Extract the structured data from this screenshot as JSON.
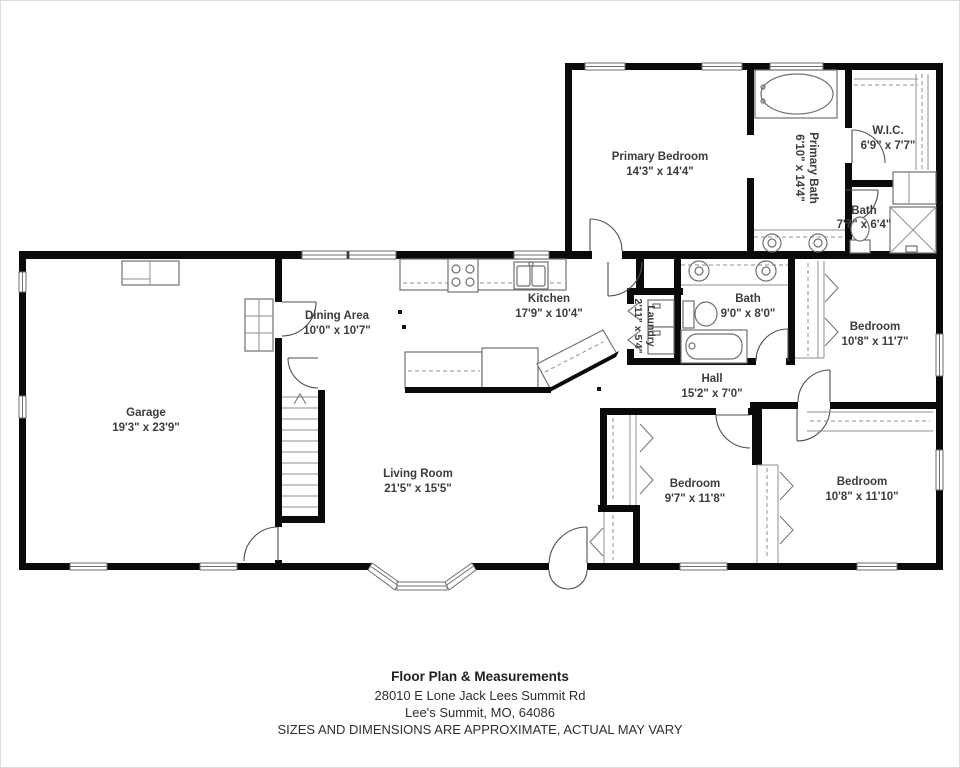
{
  "floorplan": {
    "rooms": {
      "primary_bedroom": {
        "name": "Primary Bedroom",
        "dims": "14'3\" x 14'4\""
      },
      "primary_bath": {
        "name": "Primary Bath",
        "dims": "6'10\" x 14'4\""
      },
      "wic": {
        "name": "W.I.C.",
        "dims": "6'9\" x 7'7\""
      },
      "bath_small": {
        "name": "Bath",
        "dims": "7'7\" x 6'4\""
      },
      "kitchen": {
        "name": "Kitchen",
        "dims": "17'9\" x 10'4\""
      },
      "dining": {
        "name": "Dining Area",
        "dims": "10'0\" x 10'7\""
      },
      "laundry": {
        "name": "Laundry",
        "dims": "2'11\" x 5'4\""
      },
      "bath_main": {
        "name": "Bath",
        "dims": "9'0\" x 8'0\""
      },
      "hall": {
        "name": "Hall",
        "dims": "15'2\" x 7'0\""
      },
      "garage": {
        "name": "Garage",
        "dims": "19'3\" x 23'9\""
      },
      "living": {
        "name": "Living Room",
        "dims": "21'5\" x 15'5\""
      },
      "bedroom_left": {
        "name": "Bedroom",
        "dims": "9'7\" x 11'8\""
      },
      "bedroom_right_lower": {
        "name": "Bedroom",
        "dims": "10'8\" x 11'10\""
      },
      "bedroom_right_upper": {
        "name": "Bedroom",
        "dims": "10'8\" x 11'7\""
      }
    },
    "footer": {
      "title": "Floor Plan & Measurements",
      "address": "28010 E Lone Jack Lees Summit Rd",
      "city": "Lee's Summit, MO, 64086",
      "disclaimer": "SIZES AND DIMENSIONS ARE APPROXIMATE, ACTUAL MAY VARY"
    },
    "colors": {
      "wall": "#0a0a0a",
      "fixture": "#707070",
      "label": "#3c3c3c",
      "background": "#ffffff"
    }
  }
}
